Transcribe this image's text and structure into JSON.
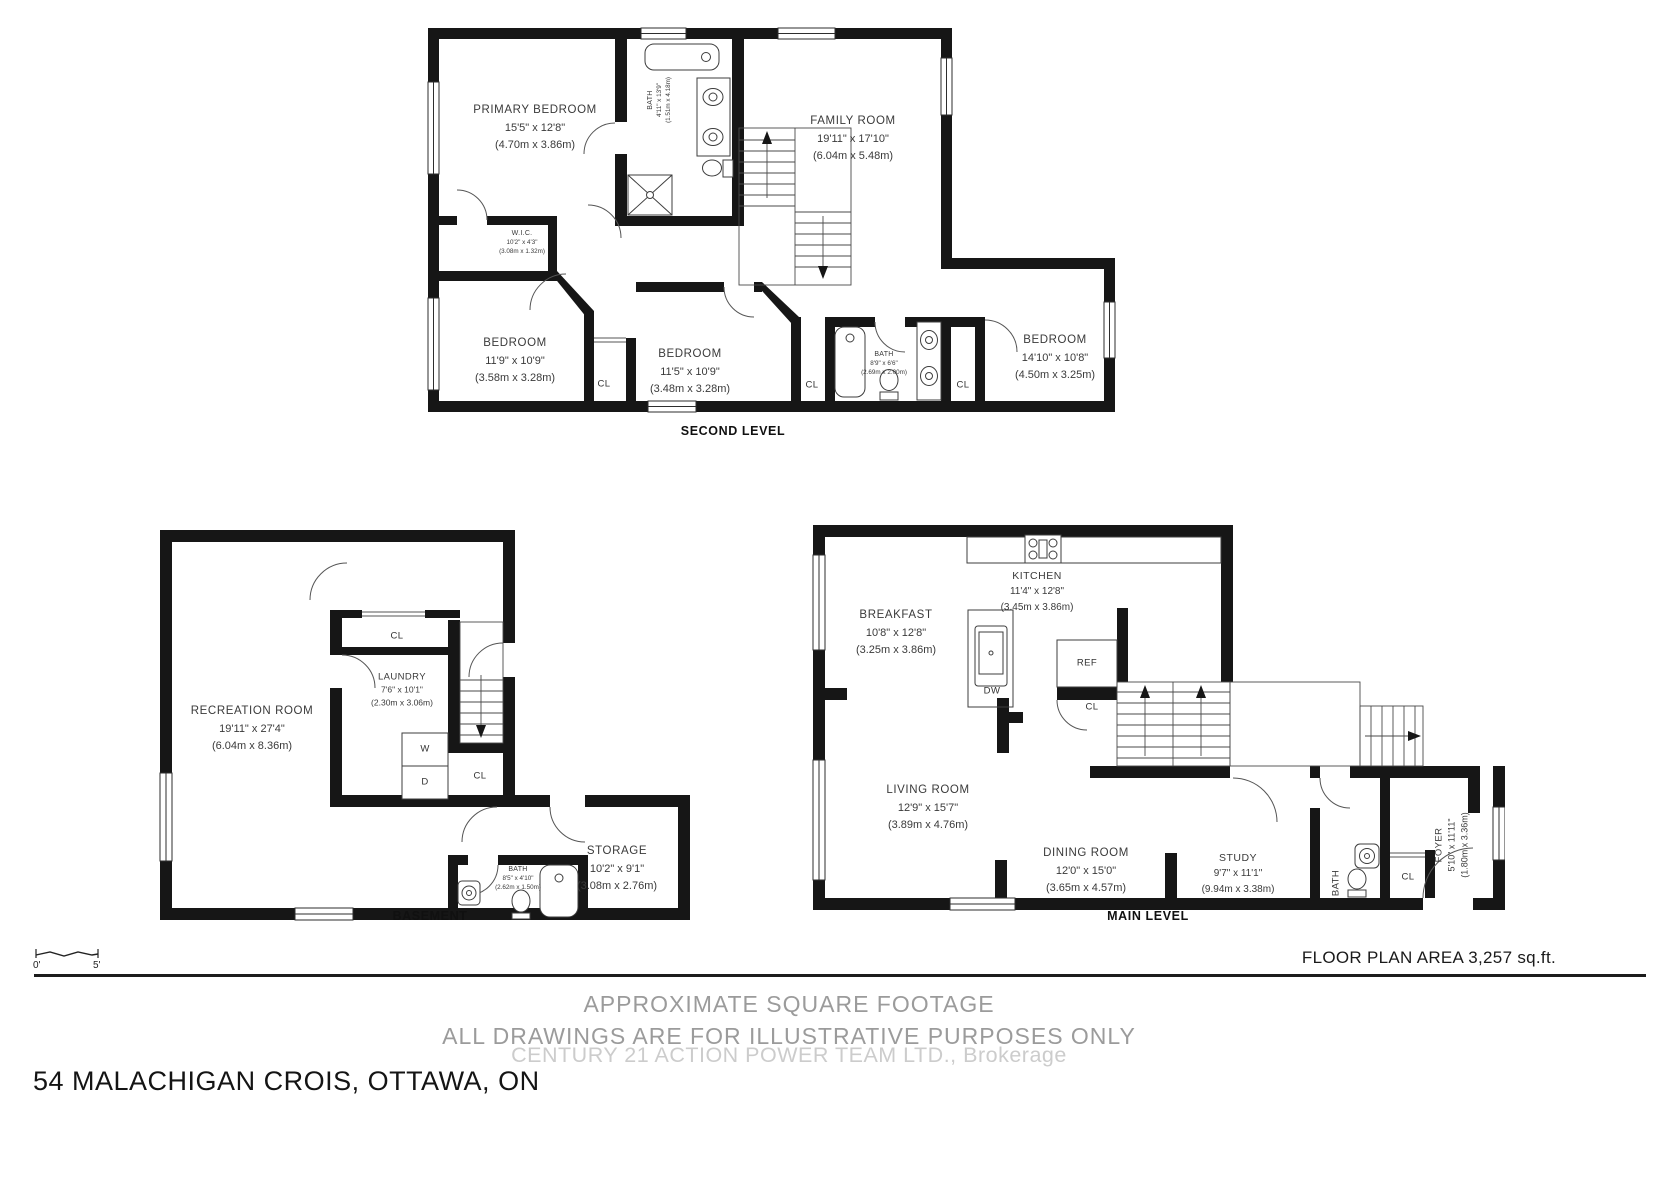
{
  "second_level": {
    "title": "SECOND LEVEL",
    "primary_bedroom": {
      "name": "PRIMARY BEDROOM",
      "imperial": "15'5\" x 12'8\"",
      "metric": "(4.70m x 3.86m)"
    },
    "ensuite_bath": {
      "name": "BATH",
      "imperial": "4'11\" x 13'9\"",
      "metric": "(1.51m x 4.18m)"
    },
    "family_room": {
      "name": "FAMILY ROOM",
      "imperial": "19'11\" x 17'10\"",
      "metric": "(6.04m x 5.48m)"
    },
    "wic": {
      "name": "W.I.C.",
      "imperial": "10'2\" x 4'3\"",
      "metric": "(3.08m x 1.32m)"
    },
    "bedroom_left": {
      "name": "BEDROOM",
      "imperial": "11'9\" x 10'9\"",
      "metric": "(3.58m x 3.28m)"
    },
    "bedroom_middle": {
      "name": "BEDROOM",
      "imperial": "11'5\" x 10'9\"",
      "metric": "(3.48m x 3.28m)"
    },
    "bath": {
      "name": "BATH",
      "imperial": "8'9\" x 6'6\"",
      "metric": "(2.69m x 2.00m)"
    },
    "bedroom_right": {
      "name": "BEDROOM",
      "imperial": "14'10\" x 10'8\"",
      "metric": "(4.50m x 3.25m)"
    },
    "closet": "CL"
  },
  "basement": {
    "title": "BASEMENT",
    "recreation_room": {
      "name": "RECREATION ROOM",
      "imperial": "19'11\" x 27'4\"",
      "metric": "(6.04m x 8.36m)"
    },
    "laundry": {
      "name": "LAUNDRY",
      "imperial": "7'6\" x 10'1\"",
      "metric": "(2.30m x 3.06m)"
    },
    "storage": {
      "name": "STORAGE",
      "imperial": "10'2\" x 9'1\"",
      "metric": "(3.08m x 2.76m)"
    },
    "bath": {
      "name": "BATH",
      "imperial": "8'5\" x 4'10\"",
      "metric": "(2.62m x 1.50m)"
    },
    "closet": "CL",
    "washer": "W",
    "dryer": "D"
  },
  "main_level": {
    "title": "MAIN LEVEL",
    "kitchen": {
      "name": "KITCHEN",
      "imperial": "11'4\" x 12'8\"",
      "metric": "(3.45m x 3.86m)"
    },
    "breakfast": {
      "name": "BREAKFAST",
      "imperial": "10'8\" x 12'8\"",
      "metric": "(3.25m x 3.86m)"
    },
    "living_room": {
      "name": "LIVING ROOM",
      "imperial": "12'9\" x 15'7\"",
      "metric": "(3.89m x 4.76m)"
    },
    "dining_room": {
      "name": "DINING ROOM",
      "imperial": "12'0\" x 15'0\"",
      "metric": "(3.65m x 4.57m)"
    },
    "study": {
      "name": "STUDY",
      "imperial": "9'7\" x 11'1\"",
      "metric": "(9.94m x 3.38m)"
    },
    "foyer": {
      "name": "FOYER",
      "imperial": "5'10\" x 11'11\"",
      "metric": "(1.80m x 3.36m)"
    },
    "bath_label": "BATH",
    "fridge": "REF",
    "dishwasher": "DW",
    "closet": "CL"
  },
  "footer": {
    "area": "FLOOR PLAN AREA 3,257 sq.ft.",
    "approx_line": "APPROXIMATE SQUARE FOOTAGE",
    "disclaimer_line": "ALL DRAWINGS ARE FOR ILLUSTRATIVE PURPOSES ONLY",
    "watermark": "CENTURY 21 ACTION POWER TEAM LTD., Brokerage",
    "address": "54 MALACHIGAN CROIS, OTTAWA, ON",
    "scale_start": "0'",
    "scale_end": "5'"
  }
}
